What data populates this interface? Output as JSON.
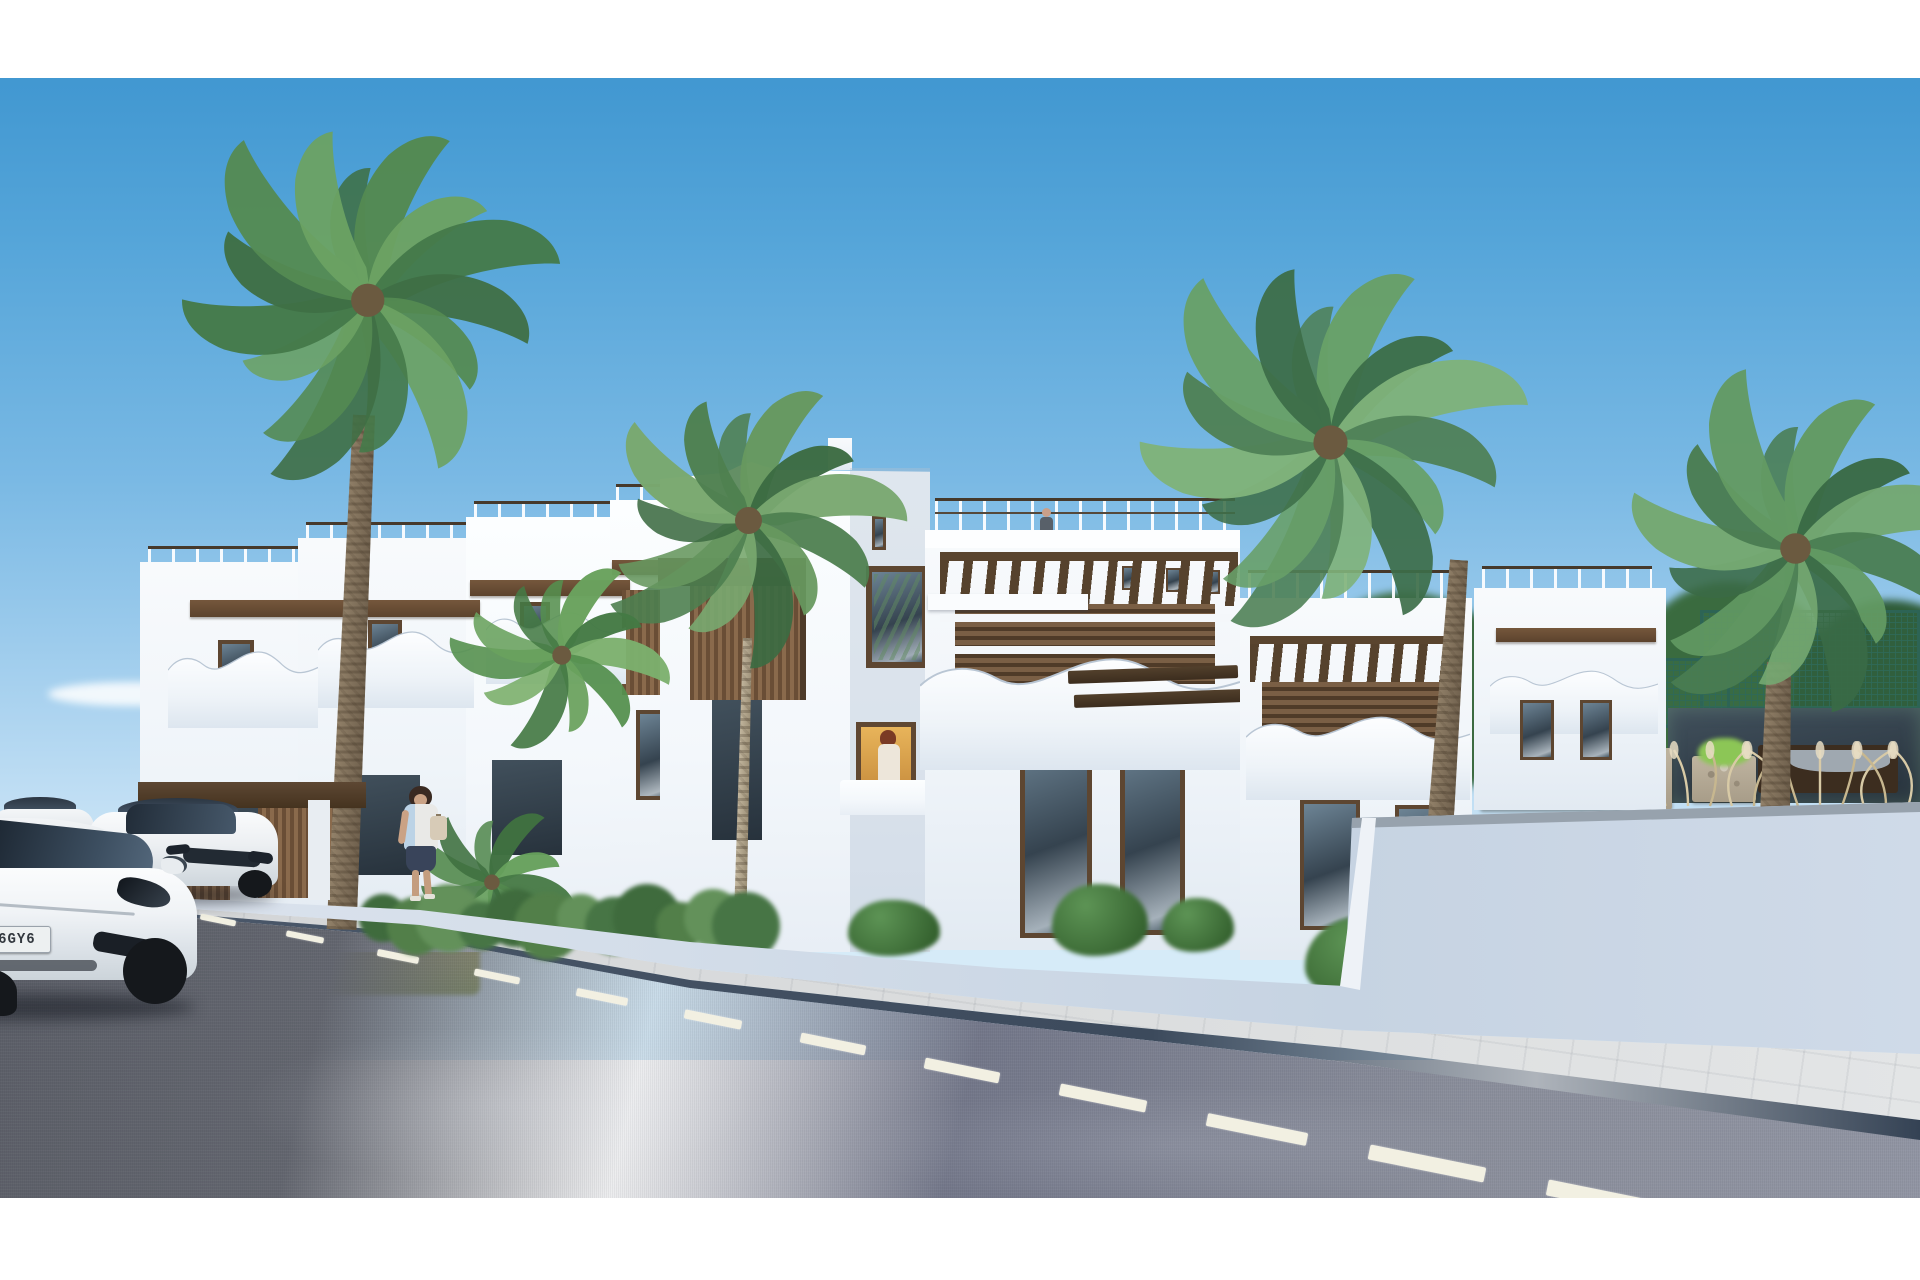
{
  "scene": {
    "kind": "3d architectural render",
    "setting": "new-build white mediterranean townhouse complex on a sunny coastal street",
    "palette": {
      "sky_top": "#3f96d0",
      "sky_horizon": "#d6ebf8",
      "building_white": "#f8fafc",
      "building_shadow": "#cbd7e3",
      "wood_accent": "#7a5f45",
      "wood_dark": "#4f3b28",
      "palm_green_dark": "#3d6e49",
      "palm_green_light": "#7fb27a",
      "hedge_green": "#527f49",
      "grass_field": "#b3b167",
      "wall_light": "#d8e0ea",
      "road_asphalt": "#6a6e79",
      "road_marking": "#f2f0e2",
      "sidewalk": "#d6d8da",
      "curb": "#44526466",
      "plate_blue": "#2257b5"
    },
    "vehicles": {
      "count": 3,
      "color": "white",
      "plate": {
        "euro_band": true,
        "text": "B 6GY6"
      }
    },
    "people": {
      "pedestrian_on_sidewalk": 1,
      "person_on_roof_terrace": 1,
      "person_at_window": 1
    },
    "vegetation": {
      "tall_palms": 4,
      "small_palms": 2,
      "hedge_row": 1,
      "pampas_grass_tufts": 12,
      "background_trees": true,
      "planters": 2
    },
    "architecture": {
      "style": "modern white townhouses",
      "floors": 2,
      "features": [
        "roof terraces with railings",
        "curved wave balcony parapets",
        "wood pergolas",
        "wood slat panels",
        "perimeter wall",
        "padel court"
      ]
    },
    "road": {
      "dash_angle_deg": 11.4,
      "dashes": [
        [
          218,
          920,
          36,
          6
        ],
        [
          305,
          937,
          38,
          6
        ],
        [
          398,
          956,
          42,
          7
        ],
        [
          497,
          976,
          46,
          7
        ],
        [
          602,
          997,
          52,
          8
        ],
        [
          713,
          1019,
          58,
          9
        ],
        [
          833,
          1044,
          66,
          10
        ],
        [
          962,
          1070,
          76,
          11
        ],
        [
          1103,
          1098,
          88,
          12
        ],
        [
          1257,
          1129,
          102,
          13
        ],
        [
          1427,
          1163,
          118,
          15
        ],
        [
          1615,
          1201,
          138,
          16
        ],
        [
          1815,
          1242,
          158,
          18
        ]
      ]
    },
    "hedge": {
      "x0": 383,
      "x1": 778,
      "y": 918
    },
    "bushes": [
      [
        848,
        900,
        92,
        56
      ],
      [
        1052,
        884,
        96,
        72
      ],
      [
        1162,
        898,
        72,
        54
      ],
      [
        1305,
        916,
        128,
        84
      ]
    ],
    "palms": [
      {
        "name": "left-large",
        "cx": 368,
        "cy": 300,
        "r": 185,
        "n": 15,
        "colors": [
          "#3f6f45",
          "#548a52",
          "#6ca263",
          "#457a4a"
        ],
        "trunk": {
          "x": 364,
          "y": 415,
          "h": 515,
          "w1": 22,
          "w2": 30,
          "rot": 2.5,
          "tone": "dark"
        }
      },
      {
        "name": "center-slim",
        "cx": 748,
        "cy": 520,
        "r": 150,
        "n": 13,
        "colors": [
          "#4e8050",
          "#67985f",
          "#3c6b42",
          "#79a86f"
        ],
        "trunk": {
          "x": 747,
          "y": 638,
          "h": 330,
          "w1": 9,
          "w2": 13,
          "rot": 1.5,
          "tone": "pale"
        }
      },
      {
        "name": "behind-hedge",
        "cx": 562,
        "cy": 655,
        "r": 105,
        "n": 11,
        "colors": [
          "#55904f",
          "#6aa25e",
          "#447a44",
          "#7cb06d"
        ]
      },
      {
        "name": "right-inner",
        "cx": 1330,
        "cy": 442,
        "r": 190,
        "n": 15,
        "colors": [
          "#4f8157",
          "#68a068",
          "#3d6e49",
          "#7fb27a"
        ],
        "trunk": {
          "x": 1459,
          "y": 560,
          "h": 260,
          "w1": 18,
          "w2": 26,
          "rot": 4,
          "tone": "dark"
        }
      },
      {
        "name": "right-outer",
        "cx": 1795,
        "cy": 548,
        "r": 170,
        "n": 14,
        "colors": [
          "#4a7d52",
          "#639a63",
          "#3a6a45",
          "#74a871"
        ],
        "trunk": {
          "x": 1779,
          "y": 662,
          "h": 150,
          "w1": 24,
          "w2": 30,
          "rot": 1.5,
          "tone": "dark"
        }
      },
      {
        "name": "fan-bush",
        "cx": 492,
        "cy": 882,
        "r": 86,
        "n": 10,
        "colors": [
          "#53894e",
          "#3f7040",
          "#66a05c",
          "#477a46"
        ]
      }
    ],
    "pampas": {
      "x": 1652,
      "y": 740,
      "w": 280,
      "h": 70
    }
  }
}
